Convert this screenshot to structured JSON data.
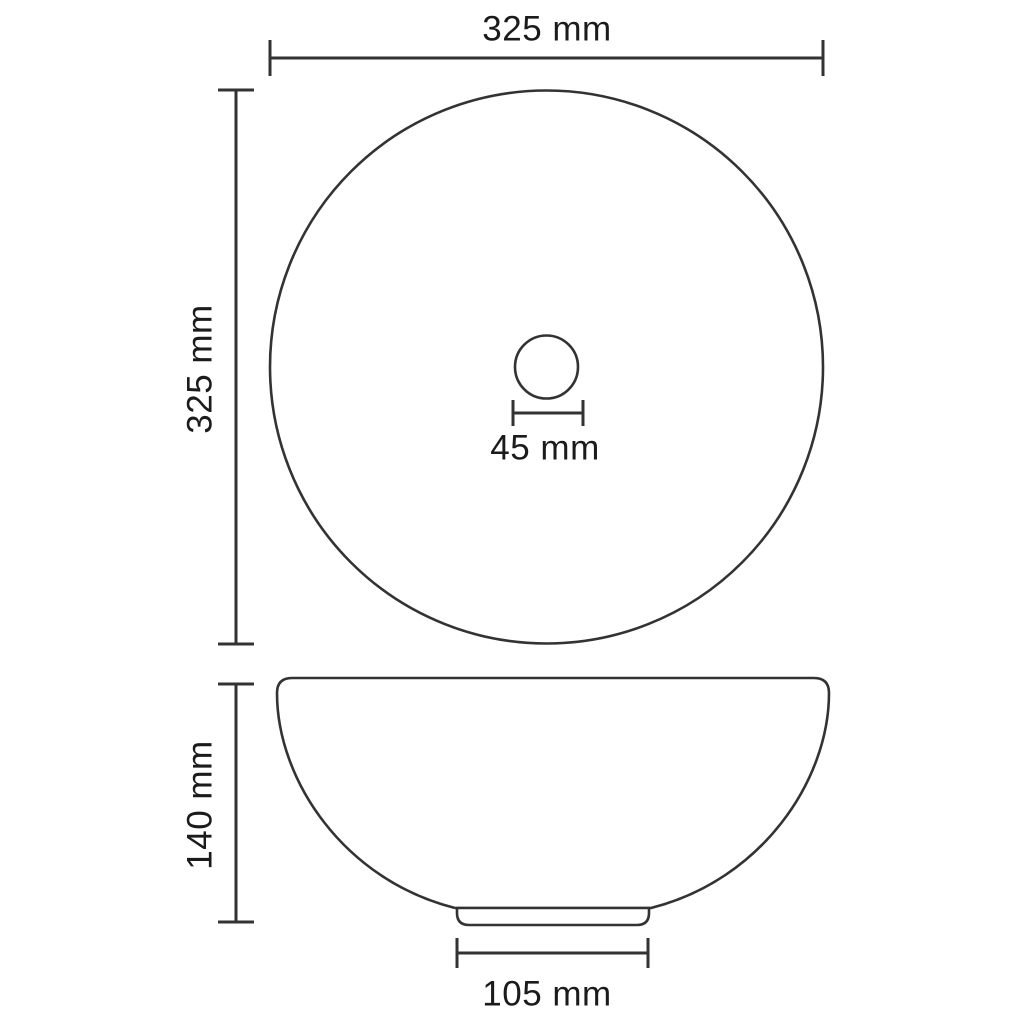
{
  "diagram": {
    "subject": "round-washbasin-dimension-drawing",
    "views": {
      "top": {
        "name": "top-view",
        "dimensions": {
          "width": "325 mm",
          "height": "325 mm",
          "drain_diameter": "45 mm"
        }
      },
      "side": {
        "name": "side-view",
        "dimensions": {
          "height": "140 mm",
          "base_width": "105 mm"
        }
      }
    },
    "colors": {
      "background": "#ffffff",
      "line": "#333333",
      "text": "#1b1b1b"
    }
  }
}
